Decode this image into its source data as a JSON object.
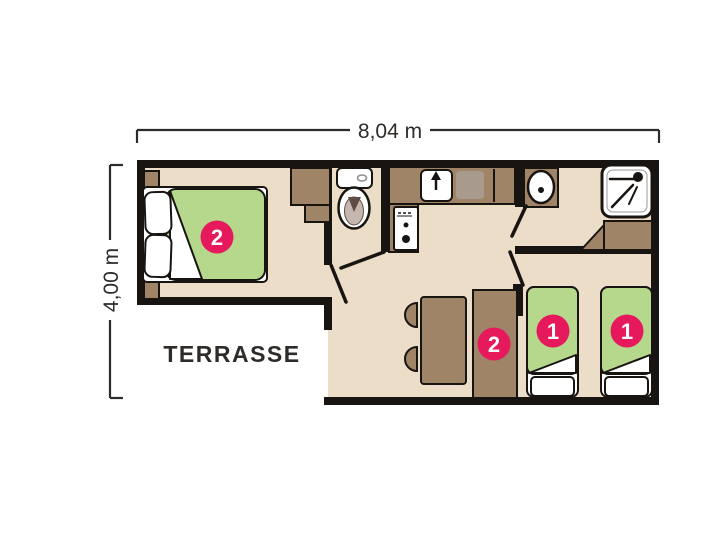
{
  "dimensions": {
    "width_label": "8,04 m",
    "height_label": "4,00 m"
  },
  "labels": {
    "terrace": "TERRASSE"
  },
  "capacity_badges": {
    "master_double_bed": "2",
    "storage_bunk": "2",
    "single_bed_left": "1",
    "single_bed_right": "1"
  },
  "furniture_icons": [
    "double-bed-icon",
    "pillow-icon",
    "nightstand-icon",
    "wardrobe-icon",
    "toilet-icon",
    "kitchen-sink-icon",
    "worktop-icon",
    "stove-icon",
    "washbasin-icon",
    "shower-icon",
    "dining-table-icon",
    "chair-icon",
    "single-bed-icon",
    "door-leaf-icon"
  ],
  "colors": {
    "wall": "#181411",
    "floor": "#ebddc7",
    "furniture_brown": "#a08468",
    "appliance_grey": "#a89a8d",
    "mattress_green": "#b5d88d",
    "badge_pink": "#e6195c",
    "dim_line": "#2e2b28",
    "text_dark": "#2e2b28",
    "toilet_inner": "#c6b6b0",
    "toilet_shadow": "#5e4d44",
    "white": "#ffffff"
  }
}
